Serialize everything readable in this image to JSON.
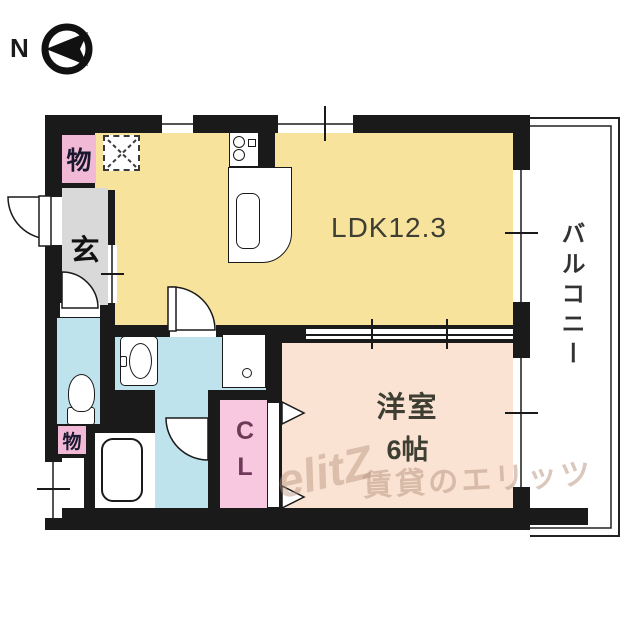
{
  "compass": {
    "north": "N"
  },
  "rooms": {
    "ldk": {
      "label": "LDK12.3",
      "color": "#F7E39C"
    },
    "western": {
      "name": "洋室",
      "size": "6帖",
      "color": "#FAE3D2"
    },
    "balcony": {
      "label": "バルコニー"
    },
    "genkan": {
      "label": "玄",
      "color": "#D9D9D9"
    },
    "storage_top": {
      "label": "物"
    },
    "storage_bottom": {
      "label": "物"
    },
    "closet": {
      "label": "CL",
      "color": "#F8C8E0"
    },
    "storage_color": "#F2B9D6",
    "wet_color": "#BFE3ED",
    "wall_color": "#1A1A1A"
  },
  "watermark": {
    "logo": "elitZ",
    "brand": "賃貸のエリッツ"
  }
}
